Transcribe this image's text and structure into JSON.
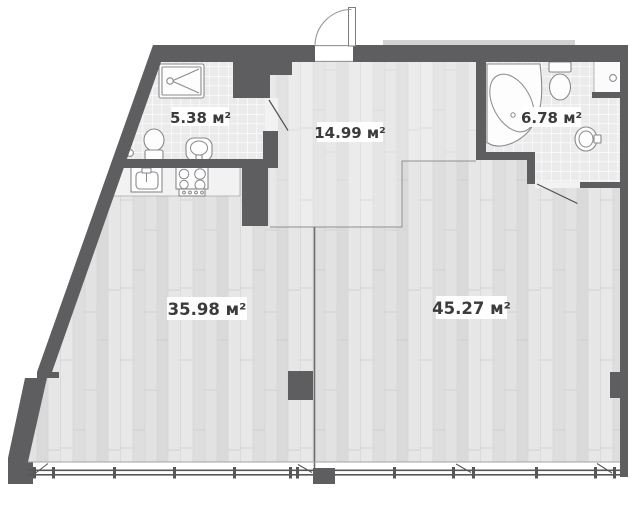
{
  "plan": {
    "type": "apartment-floor-plan",
    "rooms": [
      {
        "name": "shower-room",
        "area": "5.38 м²"
      },
      {
        "name": "entrance-hall",
        "area": "14.99 м²"
      },
      {
        "name": "bathroom",
        "area": "6.78 м²"
      },
      {
        "name": "kitchen-living-room",
        "area": "35.98 м²"
      },
      {
        "name": "living-room",
        "area": "45.27 м²"
      }
    ],
    "fixtures": [
      "shower-tray",
      "toilet",
      "washbasin",
      "kitchen-sink",
      "stove",
      "corner-bathtub",
      "ventilation-duct",
      "entrance-door",
      "interior-door",
      "panoramic-window"
    ],
    "colors": {
      "wall": "#5e5e60",
      "wood_floor": "#e4e4e4",
      "tile_floor": "#ebebeb",
      "label_text": "#3b3b3d",
      "label_background": "#ffffff"
    }
  }
}
